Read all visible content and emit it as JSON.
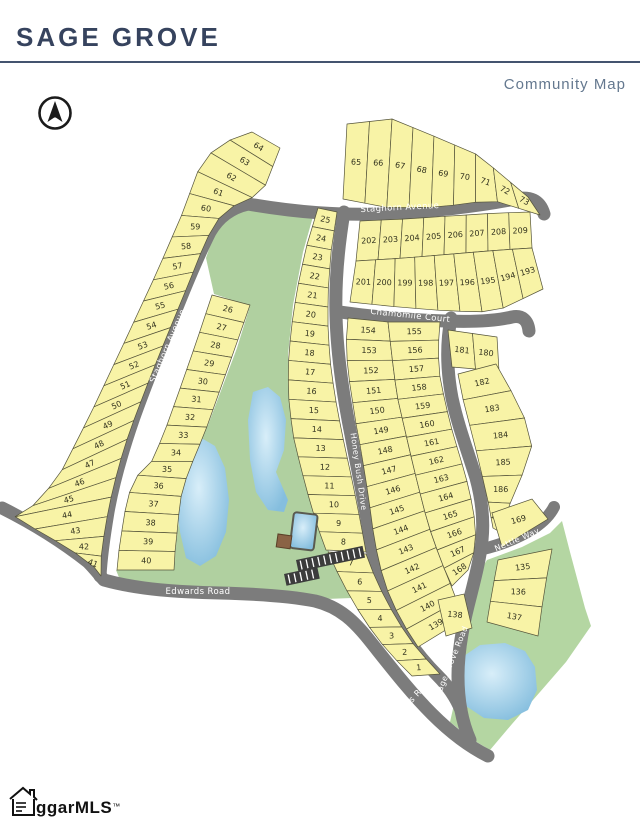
{
  "header": {
    "title": "SAGE GROVE",
    "subtitle": "Community Map"
  },
  "roads": {
    "staghorn_top": "Staghorn Avenue",
    "staghorn_west": "Staghorn Avenue",
    "chamomile": "Chamomile Court",
    "honey_bush": "Honey Bush Drive",
    "edwards_left": "Edwards Road",
    "edwards_diag": "Edwards Road",
    "sage_grove": "Sage Grove Road",
    "nettle": "Nettle Way"
  },
  "lot_strips": {
    "t1": [
      "65",
      "66",
      "67",
      "68",
      "69",
      "70",
      "71",
      "72",
      "73"
    ],
    "t2": [
      "202",
      "203",
      "204",
      "205",
      "206",
      "207",
      "208",
      "209"
    ],
    "t3": [
      "201",
      "200",
      "199",
      "198",
      "197",
      "196",
      "195",
      "194",
      "193"
    ],
    "s1": [
      "64",
      "63",
      "62",
      "61",
      "60",
      "59",
      "58",
      "57",
      "56",
      "55",
      "54",
      "53",
      "52",
      "51",
      "50",
      "49",
      "48",
      "47",
      "46",
      "45",
      "44",
      "43",
      "42",
      "41"
    ],
    "s2": [
      "26",
      "27",
      "28",
      "29",
      "30",
      "31",
      "32",
      "33",
      "34",
      "35",
      "36",
      "37",
      "38",
      "39",
      "40"
    ],
    "w": [
      "25",
      "24",
      "23",
      "22",
      "21",
      "20",
      "19",
      "18",
      "17",
      "16",
      "15",
      "14",
      "13",
      "12",
      "11",
      "10",
      "9",
      "8"
    ],
    "w2": [
      "7",
      "6",
      "5",
      "4",
      "3",
      "2",
      "1"
    ],
    "ca": [
      "154",
      "153",
      "152",
      "151",
      "150",
      "149",
      "148",
      "147",
      "146",
      "145",
      "144",
      "143",
      "142",
      "141",
      "140",
      "139"
    ],
    "cb": [
      "155",
      "156",
      "157",
      "158",
      "159",
      "160",
      "161",
      "162",
      "163",
      "164",
      "165",
      "166",
      "167",
      "168"
    ],
    "rp1": [
      "181",
      "180"
    ],
    "rp2": [
      "182",
      "183",
      "184",
      "185",
      "186",
      "187"
    ],
    "rp3": [
      "135",
      "136",
      "137"
    ]
  },
  "single_lots": {
    "lot169": "169",
    "lot138": "138"
  },
  "colors": {
    "lot_fill": "#f8f3a6",
    "lot_stroke": "#55543a",
    "road": "#7c7c7c",
    "green": "#b0d0a0",
    "green2": "#b4d6a2",
    "pond_light": "#d8eef9",
    "pond_dark": "#85bede",
    "title": "#36435e",
    "subtitle": "#64788f"
  },
  "footer": {
    "brand": "ggarMLS",
    "tm": "™"
  }
}
